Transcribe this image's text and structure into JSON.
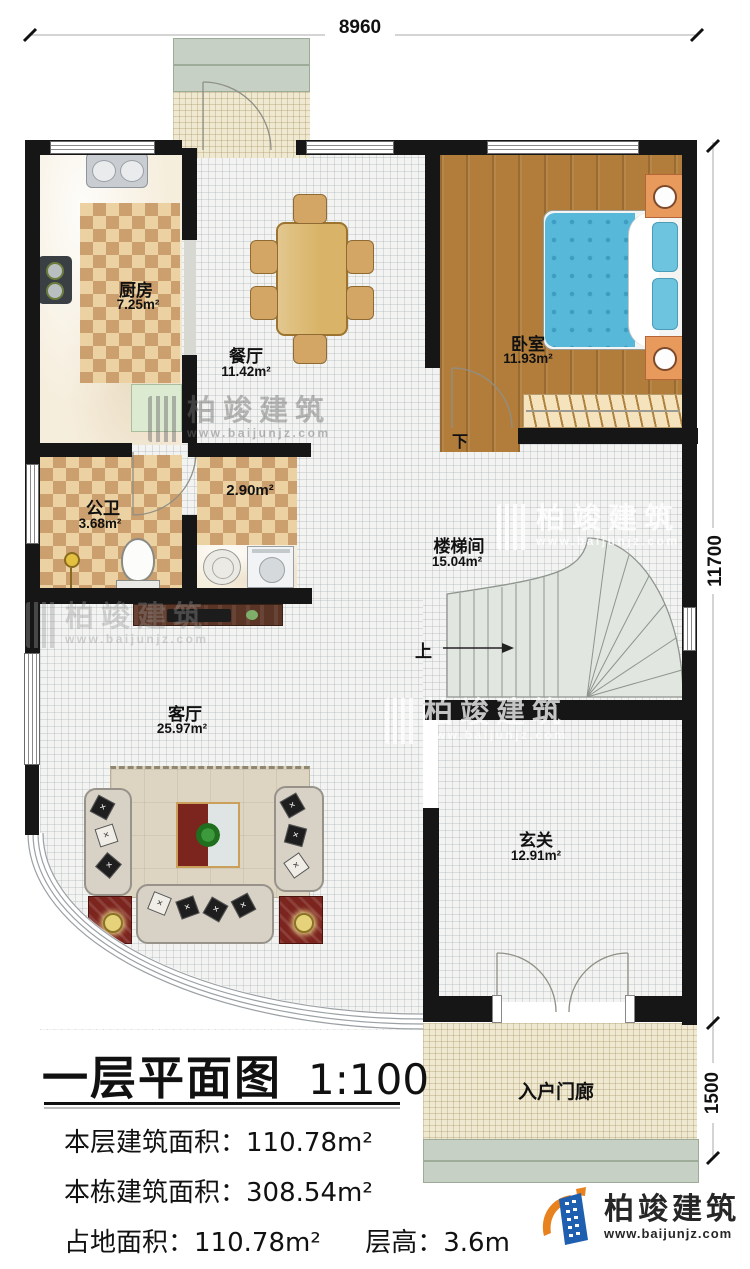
{
  "dims": {
    "top": "8960",
    "right_main": "11700",
    "right_porch": "1500"
  },
  "rooms": {
    "kitchen": {
      "name": "厨房",
      "area": "7.25m²"
    },
    "dining": {
      "name": "餐厅",
      "area": "11.42m²"
    },
    "bedroom": {
      "name": "卧室",
      "area": "11.93m²"
    },
    "bath": {
      "name": "公卫",
      "area": "3.68m²"
    },
    "washroom": {
      "area": "2.90m²"
    },
    "stairwell": {
      "name": "楼梯间",
      "area": "15.04m²"
    },
    "living": {
      "name": "客厅",
      "area": "25.97m²"
    },
    "foyer": {
      "name": "玄关",
      "area": "12.91m²"
    },
    "porch": {
      "name": "入户门廊"
    }
  },
  "stairs": {
    "up": "上",
    "down": "下"
  },
  "title": {
    "main": "一层平面图",
    "scale": "1:100"
  },
  "stats": {
    "line1": {
      "label": "本层建筑面积：",
      "value": "110.78m²"
    },
    "line2": {
      "label": "本栋建筑面积：",
      "value": "308.54m²"
    },
    "line3a": {
      "label": "占地面积：",
      "value": "110.78m²"
    },
    "line3b": {
      "label": "层高：",
      "value": "3.6m"
    }
  },
  "watermark": {
    "brand": "柏竣建筑",
    "url": "www.baijunjz.com"
  },
  "logo": {
    "brand": "柏竣建筑",
    "url": "www.baijunjz.com"
  }
}
